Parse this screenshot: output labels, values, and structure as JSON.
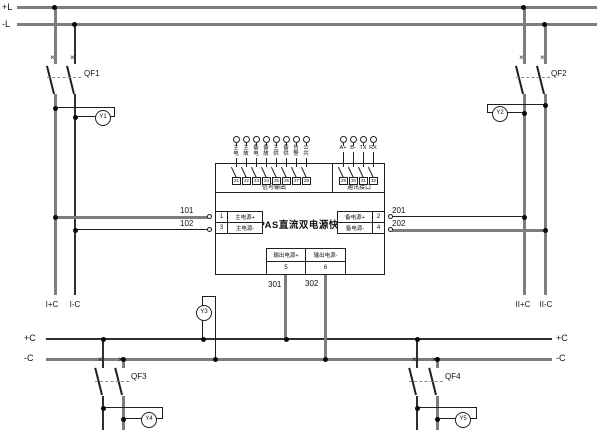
{
  "module": {
    "title": "DPAS直流双电源快切",
    "sections": {
      "signal": "信号输出",
      "comm": "通讯接口"
    },
    "signal_terminals": [
      "21",
      "22",
      "23",
      "24",
      "25",
      "26",
      "27",
      "28"
    ],
    "signal_labels": [
      "主电",
      "主故",
      "备电",
      "备故",
      "主供",
      "备供",
      "告警",
      "公共"
    ],
    "comm_terminals": [
      "29",
      "30",
      "31",
      "32"
    ],
    "comm_labels": [
      "A+",
      "B-",
      "TX",
      "RX"
    ],
    "inputs": {
      "main_pos": {
        "no": "1",
        "label": "主电源+"
      },
      "main_neg": {
        "no": "3",
        "label": "主电源-"
      },
      "backup_pos": {
        "no": "2",
        "label": "备电源+"
      },
      "backup_neg": {
        "no": "4",
        "label": "备电源-"
      }
    },
    "outputs": {
      "out_pos": {
        "no": "5",
        "label": "输出电源+"
      },
      "out_neg": {
        "no": "6",
        "label": "输出电源-"
      }
    }
  },
  "buses": {
    "top_pos": "+L",
    "top_neg": "-L",
    "bottom_pos": "+C",
    "bottom_neg": "-C"
  },
  "feeders": {
    "left_pos": "I+C",
    "left_neg": "I-C",
    "right_pos": "II+C",
    "right_neg": "II-C"
  },
  "breakers": {
    "qf1": "QF1",
    "qf2": "QF2",
    "qf3": "QF3",
    "qf4": "QF4"
  },
  "indicators": {
    "y1": "Y1",
    "y2": "Y2",
    "y3": "Y3",
    "y4": "Y4",
    "y5": "Y5"
  },
  "wires": {
    "w101": "101",
    "w102": "102",
    "w201": "201",
    "w202": "202",
    "w301": "301",
    "w302": "302"
  },
  "colors": {
    "line_dark": "#1f1f1f",
    "line_gray": "#7d7d7d",
    "background": "#ffffff"
  }
}
